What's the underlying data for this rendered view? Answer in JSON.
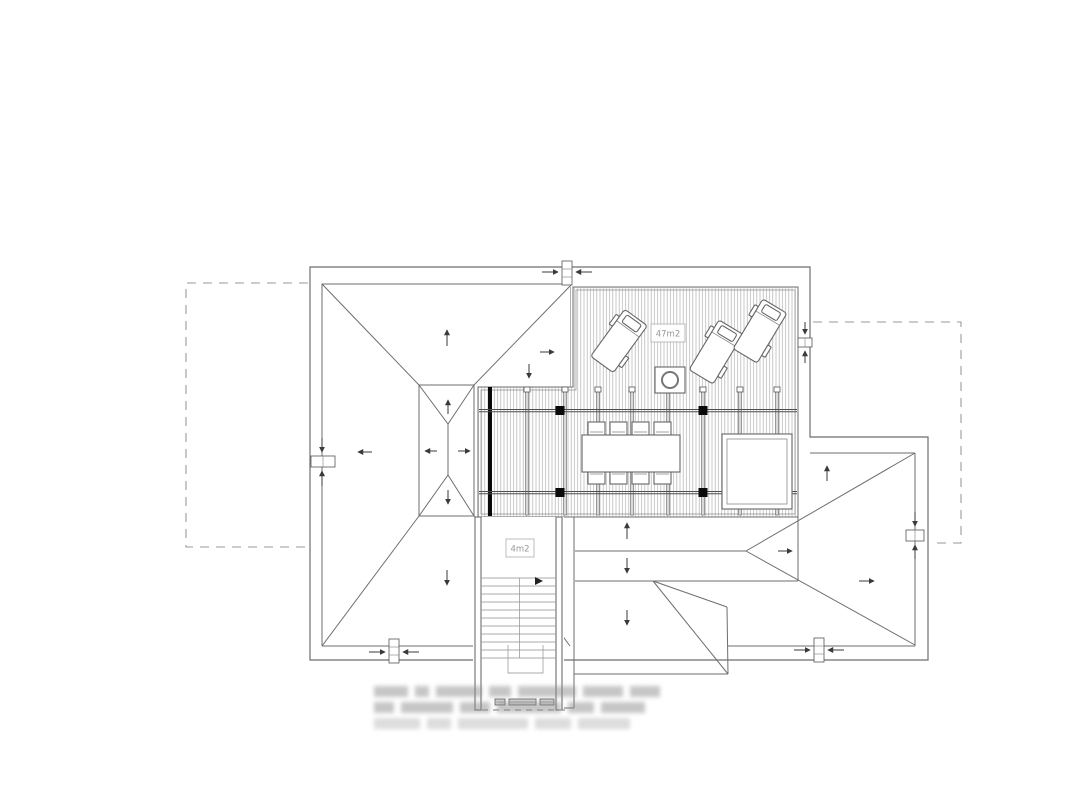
{
  "drawing": {
    "type": "roof-terrace-plan",
    "labels": {
      "terrace_area": "47m2",
      "stair_area": "4m2"
    }
  },
  "colors": {
    "line": "#6e6e6e",
    "dark": "#3a3a3a",
    "hatch": "#b0b0b0",
    "dashed": "#9a9a9a",
    "label_text": "#989898",
    "black": "#0a0a0a"
  }
}
